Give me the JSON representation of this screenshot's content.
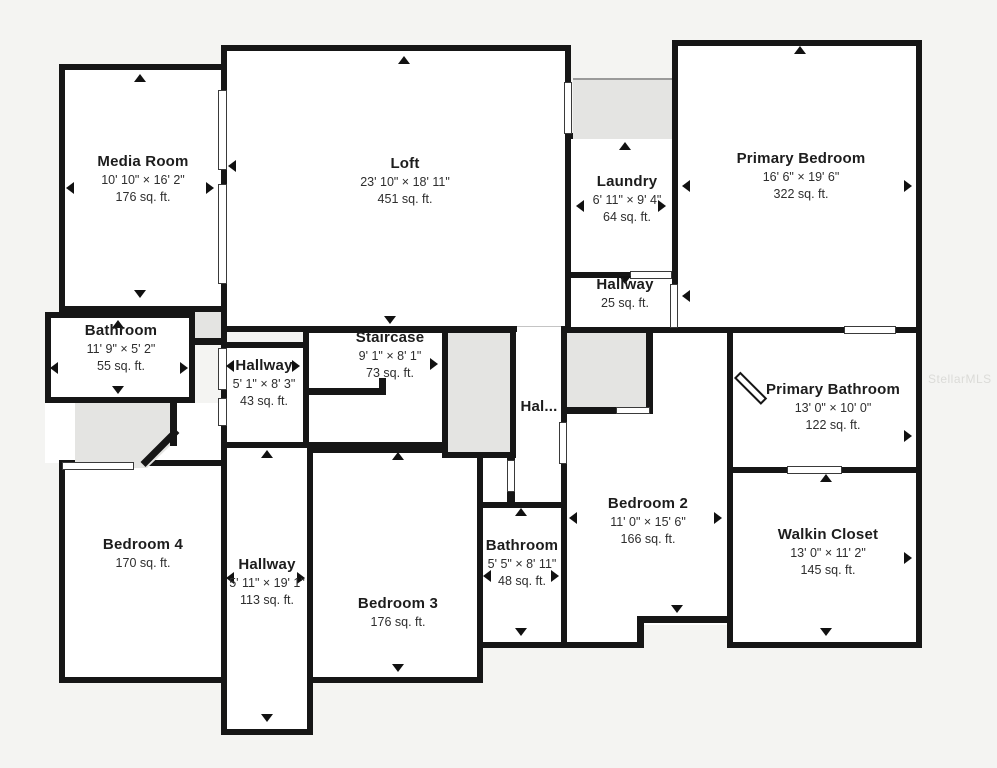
{
  "plan": {
    "background": "#f4f4f2",
    "wall_color": "#161616",
    "room_fill": "#ffffff",
    "closet_fill": "#e4e4e2",
    "watermark": "StellarMLS"
  },
  "rooms": [
    {
      "name": "Media Room",
      "dims": "10' 10\" × 16' 2\"",
      "area": "176 sq. ft."
    },
    {
      "name": "Loft",
      "dims": "23' 10\" × 18' 11\"",
      "area": "451 sq. ft."
    },
    {
      "name": "Laundry",
      "dims": "6' 11\" × 9' 4\"",
      "area": "64 sq. ft."
    },
    {
      "name": "Primary Bedroom",
      "dims": "16' 6\" × 19' 6\"",
      "area": "322 sq. ft."
    },
    {
      "name": "Hallway",
      "dims": "",
      "area": "25 sq. ft."
    },
    {
      "name": "Bathroom",
      "dims": "11' 9\" × 5' 2\"",
      "area": "55 sq. ft."
    },
    {
      "name": "Hallway",
      "dims": "5' 1\" × 8' 3\"",
      "area": "43 sq. ft."
    },
    {
      "name": "Staircase",
      "dims": "9' 1\" × 8' 1\"",
      "area": "73 sq. ft."
    },
    {
      "name": "Hal...",
      "dims": "",
      "area": ""
    },
    {
      "name": "Primary Bathroom",
      "dims": "13' 0\" × 10' 0\"",
      "area": "122 sq. ft."
    },
    {
      "name": "Bedroom 4",
      "dims": "",
      "area": "170 sq. ft."
    },
    {
      "name": "Hallway",
      "dims": "5' 11\" × 19' 1\"",
      "area": "113 sq. ft."
    },
    {
      "name": "Bedroom 3",
      "dims": "",
      "area": "176 sq. ft."
    },
    {
      "name": "Bathroom",
      "dims": "5' 5\" × 8' 11\"",
      "area": "48 sq. ft."
    },
    {
      "name": "Bedroom 2",
      "dims": "11' 0\" × 15' 6\"",
      "area": "166 sq. ft."
    },
    {
      "name": "Walkin Closet",
      "dims": "13' 0\" × 11' 2\"",
      "area": "145 sq. ft."
    }
  ]
}
